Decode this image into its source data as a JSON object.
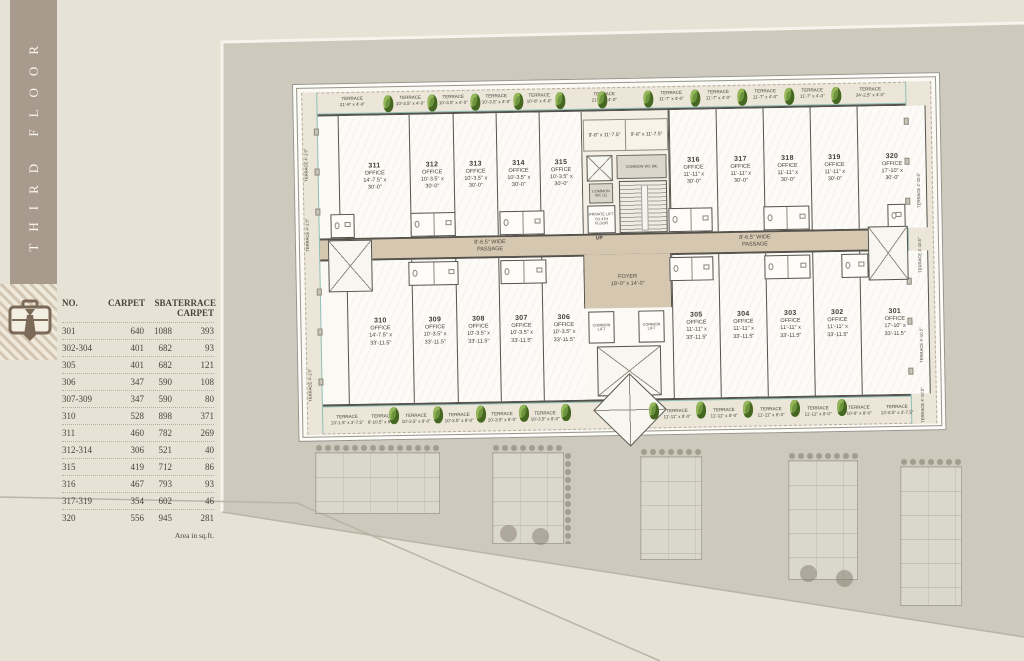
{
  "page": {
    "floor_label": "THIRD FLOOR",
    "footnote": "Area in sq.ft."
  },
  "area_table": {
    "col_no": "NO.",
    "col_carpet": "CARPET",
    "col_sba": "SBA",
    "col_terrace_1": "TERRACE",
    "col_terrace_2": "CARPET",
    "rows": [
      {
        "no": "301",
        "carpet": "640",
        "sba": "1088",
        "terrace": "393"
      },
      {
        "no": "302-304",
        "carpet": "401",
        "sba": "682",
        "terrace": "93"
      },
      {
        "no": "305",
        "carpet": "401",
        "sba": "682",
        "terrace": "121"
      },
      {
        "no": "306",
        "carpet": "347",
        "sba": "590",
        "terrace": "108"
      },
      {
        "no": "307-309",
        "carpet": "347",
        "sba": "590",
        "terrace": "80"
      },
      {
        "no": "310",
        "carpet": "528",
        "sba": "898",
        "terrace": "371"
      },
      {
        "no": "311",
        "carpet": "460",
        "sba": "782",
        "terrace": "269"
      },
      {
        "no": "312-314",
        "carpet": "306",
        "sba": "521",
        "terrace": "40"
      },
      {
        "no": "315",
        "carpet": "419",
        "sba": "712",
        "terrace": "86"
      },
      {
        "no": "316",
        "carpet": "467",
        "sba": "793",
        "terrace": "93"
      },
      {
        "no": "317-319",
        "carpet": "354",
        "sba": "602",
        "terrace": "46"
      },
      {
        "no": "320",
        "carpet": "556",
        "sba": "945",
        "terrace": "281"
      }
    ]
  },
  "plan": {
    "passage_l1": "8'-6.5\" WIDE",
    "passage_l2": "PASSAGE",
    "foyer": {
      "l1": "FOYER",
      "l2": "19'-0\" x 14'-0\""
    },
    "common_lift": "COMMON LIFT",
    "core": {
      "terrace_a": "9'-8\" x 11'-7.5\"",
      "terrace_b": "9'-8\" x 11'-7.5\"",
      "wc_m": "COMMON WC (M)",
      "wc_l": "COMMON WC (L)",
      "private_lift": "PRIVATE LIFT TO 4TH FLOOR",
      "up": "UP"
    },
    "offices_top": [
      {
        "no": "311",
        "type": "OFFICE",
        "d1": "14'-7.5\" x",
        "d2": "30'-0\""
      },
      {
        "no": "312",
        "type": "OFFICE",
        "d1": "10'-3.5\" x",
        "d2": "30'-0\""
      },
      {
        "no": "313",
        "type": "OFFICE",
        "d1": "10'-3.5\" x",
        "d2": "30'-0\""
      },
      {
        "no": "314",
        "type": "OFFICE",
        "d1": "10'-3.5\" x",
        "d2": "30'-0\""
      },
      {
        "no": "315",
        "type": "OFFICE",
        "d1": "10'-3.5\" x",
        "d2": "30'-0\""
      },
      {
        "no": "316",
        "type": "OFFICE",
        "d1": "11'-11\" x",
        "d2": "30'-0\""
      },
      {
        "no": "317",
        "type": "OFFICE",
        "d1": "11'-11\" x",
        "d2": "30'-0\""
      },
      {
        "no": "318",
        "type": "OFFICE",
        "d1": "11'-11\" x",
        "d2": "30'-0\""
      },
      {
        "no": "319",
        "type": "OFFICE",
        "d1": "11'-11\" x",
        "d2": "30'-0\""
      },
      {
        "no": "320",
        "type": "OFFICE",
        "d1": "17'-10\" x",
        "d2": "30'-0\""
      }
    ],
    "offices_bottom": [
      {
        "no": "310",
        "type": "OFFICE",
        "d1": "14'-7.5\" x",
        "d2": "33'-11.5\""
      },
      {
        "no": "309",
        "type": "OFFICE",
        "d1": "10'-3.5\" x",
        "d2": "33'-11.5\""
      },
      {
        "no": "308",
        "type": "OFFICE",
        "d1": "10'-3.5\" x",
        "d2": "33'-11.5\""
      },
      {
        "no": "307",
        "type": "OFFICE",
        "d1": "10'-3.5\" x",
        "d2": "33'-11.5\""
      },
      {
        "no": "306",
        "type": "OFFICE",
        "d1": "10'-3.5\" x",
        "d2": "33'-11.5\""
      },
      {
        "no": "305",
        "type": "OFFICE",
        "d1": "11'-11\" x",
        "d2": "33'-11.5\""
      },
      {
        "no": "304",
        "type": "OFFICE",
        "d1": "11'-11\" x",
        "d2": "33'-11.5\""
      },
      {
        "no": "303",
        "type": "OFFICE",
        "d1": "11'-11\" x",
        "d2": "33'-11.5\""
      },
      {
        "no": "302",
        "type": "OFFICE",
        "d1": "11'-11\" x",
        "d2": "33'-11.5\""
      },
      {
        "no": "301",
        "type": "OFFICE",
        "d1": "17'-10\" x",
        "d2": "33'-11.5\""
      }
    ],
    "terraces_top": [
      {
        "t": "TERRACE",
        "d": "21'-9\" x 4'-0\""
      },
      {
        "t": "TERRACE",
        "d": "10'-3.5\" x 4'-0\""
      },
      {
        "t": "TERRACE",
        "d": "10'-3.5\" x 4'-0\""
      },
      {
        "t": "TERRACE",
        "d": "10'-3.5\" x 4'-0\""
      },
      {
        "t": "TERRACE",
        "d": "10'-8\" x 4'-0\""
      },
      {
        "t": "TERRACE",
        "d": "21'-7\" x 4'-0\""
      },
      {
        "t": "TERRACE",
        "d": "11'-7\" x 4'-0\""
      },
      {
        "t": "TERRACE",
        "d": "11'-7\" x 4'-0\""
      },
      {
        "t": "TERRACE",
        "d": "11'-7\" x 4'-0\""
      },
      {
        "t": "TERRACE",
        "d": "11'-7\" x 4'-0\""
      },
      {
        "t": "TERRACE",
        "d": "34'-2.5\" x 4'-0\""
      }
    ],
    "terraces_bottom": [
      {
        "t": "TERRACE",
        "d": "13'-1.5\" x 3'-7.5\""
      },
      {
        "t": "TERRACE",
        "d": "8'-10.5\" x 8'-0\""
      },
      {
        "t": "TERRACE",
        "d": "10'-3.5\" x 8'-0\""
      },
      {
        "t": "TERRACE",
        "d": "10'-3.5\" x 8'-0\""
      },
      {
        "t": "TERRACE",
        "d": "10'-3.5\" x 8'-0\""
      },
      {
        "t": "TERRACE",
        "d": "10'-3.5\" x 8'-0\""
      },
      {
        "t": "TERRACE",
        "d": "11'-11\" x 8'-0\""
      },
      {
        "t": "TERRACE",
        "d": "11'-11\" x 8'-0\""
      },
      {
        "t": "TERRACE",
        "d": "11'-11\" x 8'-0\""
      },
      {
        "t": "TERRACE",
        "d": "11'-11\" x 8'-0\""
      },
      {
        "t": "TERRACE",
        "d": "10'-8\" x 8'-0\""
      },
      {
        "t": "TERRACE",
        "d": "13'-8.5\" x 3'-7.5\""
      }
    ],
    "terraces_left": [
      {
        "t": "TERRACE",
        "d": "4'-1.5\""
      },
      {
        "t": "TERRACE",
        "d": "4'-1.5\""
      },
      {
        "t": "TERRACE",
        "d": "4'-1.5\""
      }
    ],
    "terraces_right": [
      {
        "t": "TERRACE",
        "d": "4'-10.5\""
      },
      {
        "t": "TERRACE",
        "d": "4'-10.5\""
      },
      {
        "t": "TERRACE",
        "d": "4'-10.5\""
      },
      {
        "t": "TERRACE",
        "d": "4'-10.5\""
      }
    ]
  },
  "colors": {
    "band": "#a89a8d",
    "passage": "#d6c7b1",
    "terrace_strip": "#ece6d8",
    "plant": "#6f9440",
    "teal": "#8fc0b8",
    "site": "#cdc9bc"
  }
}
